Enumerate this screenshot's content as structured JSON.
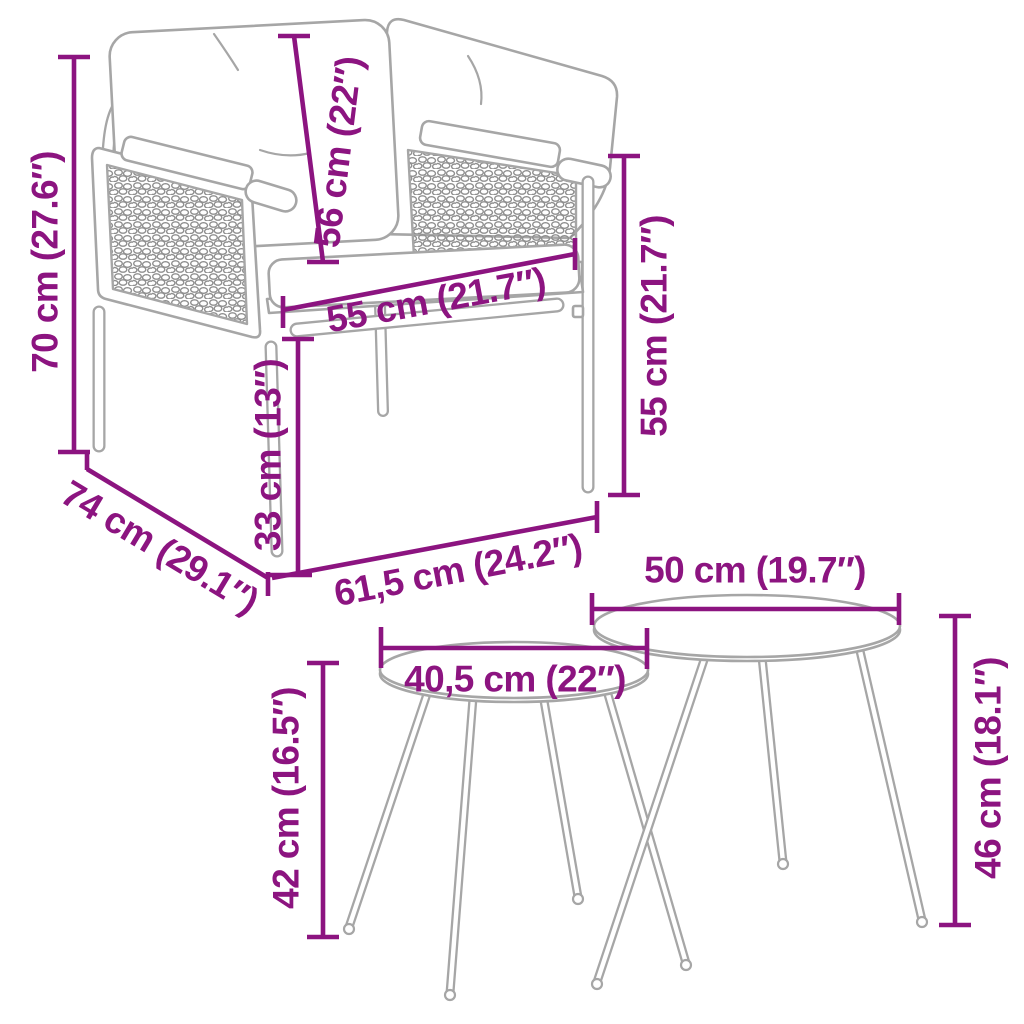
{
  "colors": {
    "dimension": "#8c1480",
    "line_art": "#a6a6a6",
    "weave": "#8f8f8f",
    "background": "#ffffff"
  },
  "chair": {
    "dimensions": {
      "height": "70 cm (27.6″)",
      "cushion_height": "56 cm (22″)",
      "seat_width": "55 cm (21.7″)",
      "side_height": "55 cm (21.7″)",
      "seat_height": "33 cm (13″)",
      "depth": "74 cm (29.1″)",
      "width": "61,5 cm (24.2″)"
    }
  },
  "tables": {
    "dimensions": {
      "large_diameter": "50 cm (19.7″)",
      "small_diameter": "40,5 cm (22″)",
      "small_height": "42 cm (16.5″)",
      "large_height": "46 cm (18.1″)"
    }
  }
}
